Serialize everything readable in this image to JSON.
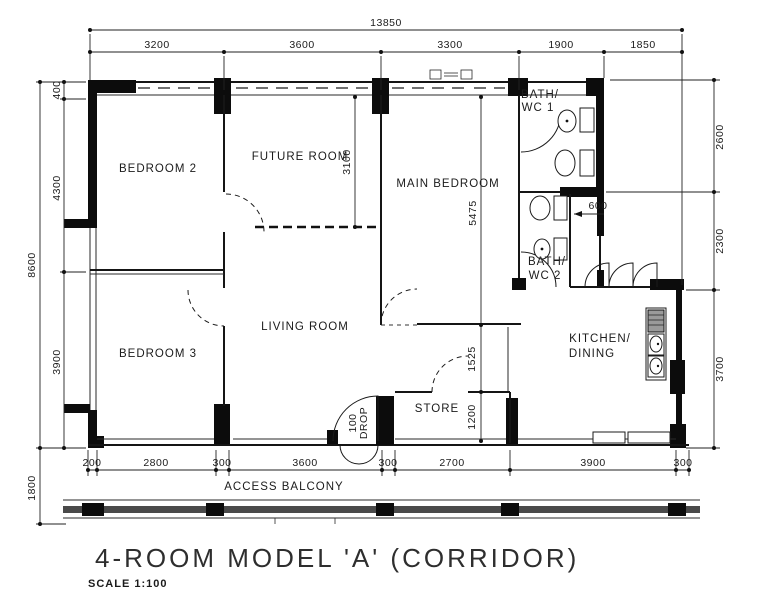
{
  "title": {
    "main": "4-ROOM  MODEL  'A'   (CORRIDOR)",
    "scale": "SCALE   1:100"
  },
  "rooms": {
    "bedroom2": "BEDROOM 2",
    "future": "FUTURE ROOM",
    "main_bedroom": "MAIN BEDROOM",
    "bedroom3": "BEDROOM 3",
    "living": "LIVING ROOM",
    "store": "STORE",
    "kitchen_line1": "KITCHEN/",
    "kitchen_line2": "DINING",
    "bath1_line1": "BATH/",
    "bath1_line2": "WC 1",
    "bath2_line1": "BATH/",
    "bath2_line2": "WC 2",
    "balcony": "ACCESS   BALCONY"
  },
  "dimensions": {
    "overall_width": "13850",
    "top": [
      "3200",
      "3600",
      "3300",
      "1900",
      "1850"
    ],
    "left_overall": "8600",
    "left_lower": "1800",
    "left_inner": [
      "400",
      "4300",
      "3900"
    ],
    "right": [
      "2600",
      "2300",
      "3700"
    ],
    "bottom": [
      "200",
      "2800",
      "300",
      "3600",
      "300",
      "2700",
      "3900",
      "300"
    ],
    "future_room_depth": "3100",
    "main_bedroom_depth": "5475",
    "hall_width": "1525",
    "store_depth": "1200",
    "duct": "600",
    "drop_value": "100",
    "drop_label": "DROP"
  },
  "colors": {
    "ink": "#1b1b1b",
    "paper": "#ffffff"
  }
}
